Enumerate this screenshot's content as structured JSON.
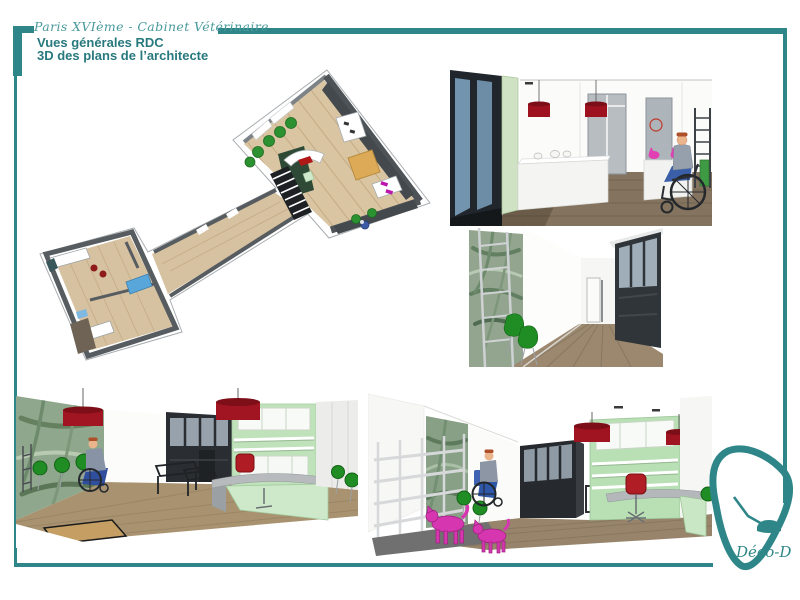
{
  "header": {
    "project_title": "Paris XVIème - Cabinet Vétérinaire",
    "view_title": "Vues générales RDC",
    "view_subtitle": "3D des plans de l’architecte"
  },
  "footer": {
    "logo_text": "Déco-D"
  },
  "icons": {
    "logo_mark": "desk-lamp-in-pick-outline"
  },
  "colors": {
    "accent_teal": "#2F8688",
    "lamp_red": "#A01320",
    "mint_green": "#BCE0B8",
    "chair_green": "#1F8C24",
    "dog_magenta": "#D637B0",
    "wood_floor_light": "#D9C5A2",
    "wood_floor_dark": "#7D6D5A",
    "wall_grey": "#5B6065",
    "partition_dark": "#26292D",
    "wallpaper_green": "#90A890"
  },
  "renders": [
    {
      "name": "floor-plan-axonometric-3d"
    },
    {
      "name": "entrance-reception-view"
    },
    {
      "name": "corridor-waiting-view"
    },
    {
      "name": "waiting-area-desk-view"
    },
    {
      "name": "retail-office-view"
    }
  ]
}
